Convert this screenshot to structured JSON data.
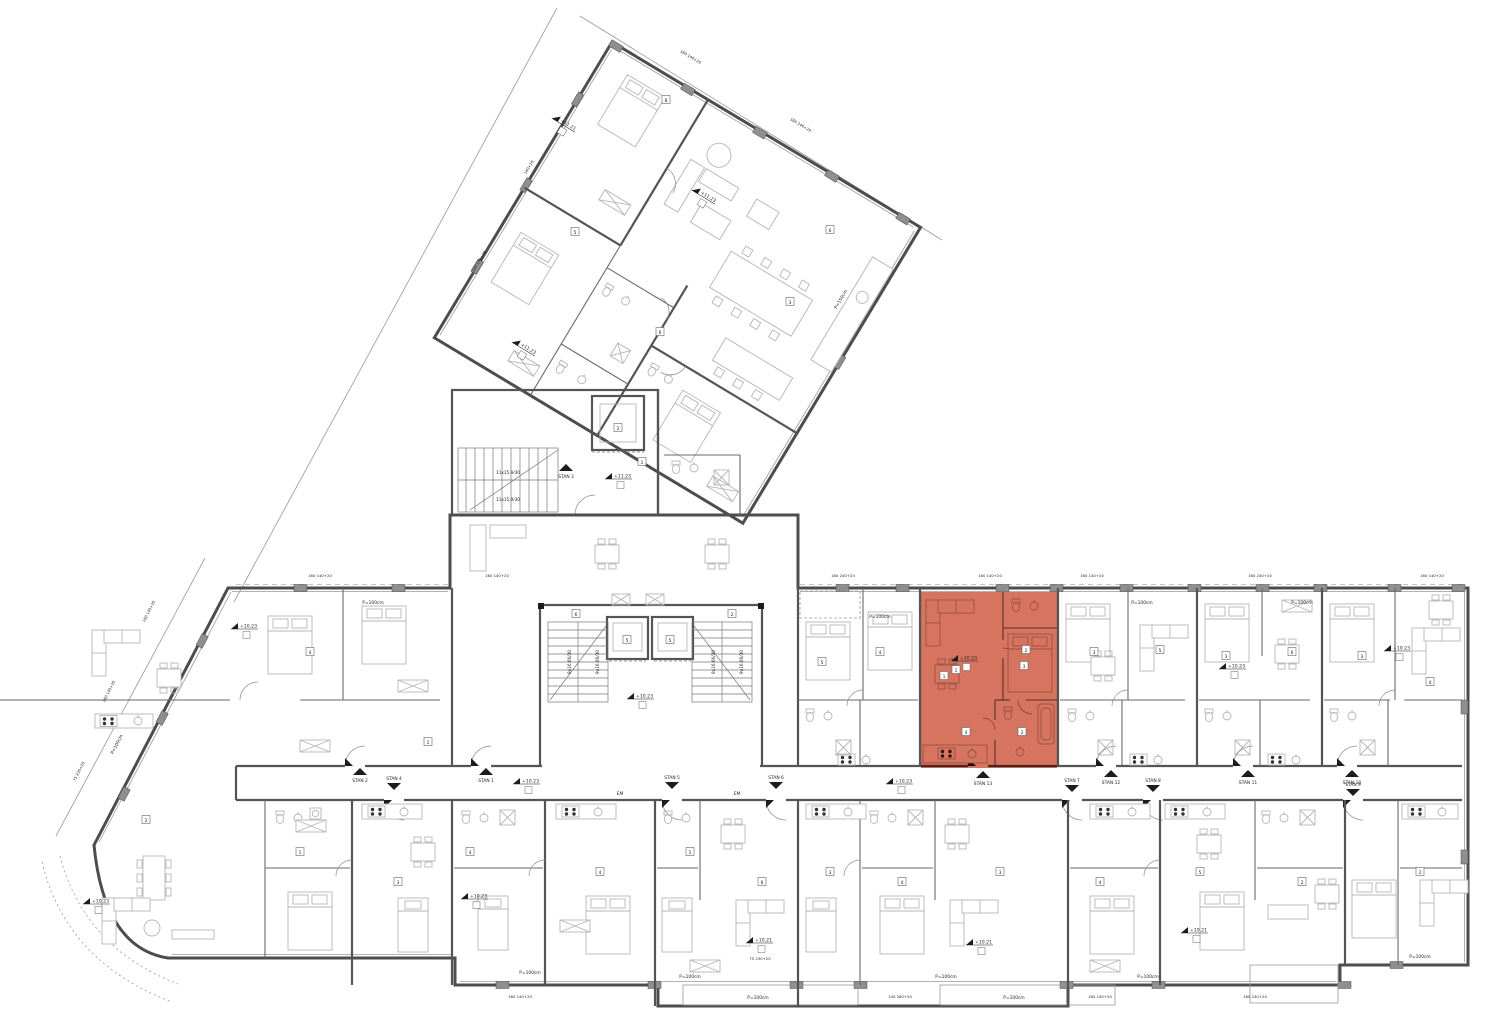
{
  "drawing": {
    "type": "residential floor plan",
    "highlight": {
      "unit": "STAN 13",
      "color": "#d2654e",
      "opacity": "0.9"
    },
    "colors": {
      "ink": "#1c1c1c",
      "wall": "#4d4d4d",
      "furniture": "#b5b5b5",
      "pillar": "#8f8f8f",
      "parcel": "#999999"
    }
  },
  "annotations": {
    "units": [
      {
        "name": "STAN 2",
        "x": 360,
        "y": 774,
        "dir": "up"
      },
      {
        "name": "STAN 4",
        "x": 394,
        "y": 784,
        "dir": "down"
      },
      {
        "name": "STAN 1",
        "x": 486,
        "y": 774,
        "dir": "up"
      },
      {
        "name": "STAN 3",
        "x": 566,
        "y": 470,
        "dir": "up"
      },
      {
        "name": "STAN 5",
        "x": 672,
        "y": 783,
        "dir": "down"
      },
      {
        "name": "STAN 6",
        "x": 776,
        "y": 783,
        "dir": "down"
      },
      {
        "name": "STAN 13",
        "x": 983,
        "y": 777,
        "dir": "up"
      },
      {
        "name": "STAN 7",
        "x": 1072,
        "y": 786,
        "dir": "down"
      },
      {
        "name": "STAN 12",
        "x": 1111,
        "y": 776,
        "dir": "up"
      },
      {
        "name": "STAN 8",
        "x": 1153,
        "y": 786,
        "dir": "down"
      },
      {
        "name": "STAN 11",
        "x": 1248,
        "y": 776,
        "dir": "up"
      },
      {
        "name": "STAN 10",
        "x": 1352,
        "y": 776,
        "dir": "up"
      },
      {
        "name": "STAN 9",
        "x": 1353,
        "y": 790,
        "dir": "down"
      }
    ],
    "levels": [
      {
        "text": "+10.23",
        "x": 240,
        "y": 628,
        "rot": 0
      },
      {
        "text": "+10.23",
        "x": 522,
        "y": 783,
        "rot": 0
      },
      {
        "text": "+10.23",
        "x": 636,
        "y": 698,
        "rot": 0
      },
      {
        "text": "+10.23",
        "x": 895,
        "y": 783,
        "rot": 0
      },
      {
        "text": "+10.23",
        "x": 960,
        "y": 660,
        "rot": 0
      },
      {
        "text": "+10.23",
        "x": 1228,
        "y": 668,
        "rot": 0
      },
      {
        "text": "+10.23",
        "x": 1393,
        "y": 650,
        "rot": 0
      },
      {
        "text": "+10.23",
        "x": 470,
        "y": 898,
        "rot": 0
      },
      {
        "text": "+10.23",
        "x": 92,
        "y": 903,
        "rot": 0
      },
      {
        "text": "+10.21",
        "x": 755,
        "y": 942,
        "rot": 0
      },
      {
        "text": "+10.21",
        "x": 975,
        "y": 944,
        "rot": 0
      },
      {
        "text": "+10.21",
        "x": 1190,
        "y": 932,
        "rot": 0
      },
      {
        "text": "+11.23",
        "x": 614,
        "y": 478,
        "rot": 0
      },
      {
        "text": "+11.23",
        "x": 700,
        "y": 194,
        "rot": 31
      },
      {
        "text": "+11.23",
        "x": 520,
        "y": 346,
        "rot": 31
      },
      {
        "text": "+11.21",
        "x": 560,
        "y": 122,
        "rot": 31
      }
    ],
    "stairs": [
      {
        "text": "9x16.66/30",
        "x": 571,
        "y": 662,
        "rot": -90
      },
      {
        "text": "9x16.66/30",
        "x": 599,
        "y": 662,
        "rot": -90
      },
      {
        "text": "9x16.66/30",
        "x": 715,
        "y": 662,
        "rot": -90
      },
      {
        "text": "9x16.66/30",
        "x": 743,
        "y": 662,
        "rot": -90
      },
      {
        "text": "11x15.9/30",
        "x": 508,
        "y": 474,
        "rot": 0
      },
      {
        "text": "11x15.9/30",
        "x": 508,
        "y": 501,
        "rot": 0
      }
    ],
    "notes": [
      {
        "text": "EM",
        "x": 620,
        "y": 795,
        "rot": 0
      },
      {
        "text": "EM",
        "x": 737,
        "y": 795,
        "rot": 0
      },
      {
        "text": "P=100cm",
        "x": 373,
        "y": 604,
        "rot": 0
      },
      {
        "text": "P=100cm",
        "x": 880,
        "y": 618,
        "rot": 0
      },
      {
        "text": "P=100cm",
        "x": 1142,
        "y": 604,
        "rot": 0
      },
      {
        "text": "P=100cm",
        "x": 1302,
        "y": 604,
        "rot": 0
      },
      {
        "text": "P=100cm",
        "x": 530,
        "y": 974,
        "rot": 0
      },
      {
        "text": "P=100cm",
        "x": 690,
        "y": 978,
        "rot": 0
      },
      {
        "text": "P=100cm",
        "x": 758,
        "y": 999,
        "rot": 0
      },
      {
        "text": "P=100cm",
        "x": 946,
        "y": 978,
        "rot": 0
      },
      {
        "text": "P=100cm",
        "x": 1014,
        "y": 999,
        "rot": 0
      },
      {
        "text": "P=100cm",
        "x": 1148,
        "y": 978,
        "rot": 0
      },
      {
        "text": "P=100cm",
        "x": 1420,
        "y": 958,
        "rot": 0
      },
      {
        "text": "P=100cm",
        "x": 118,
        "y": 745,
        "rot": -63
      },
      {
        "text": "P=150cm",
        "x": 842,
        "y": 300,
        "rot": -59
      }
    ],
    "dims": [
      {
        "text": "160  140+20",
        "x": 320,
        "y": 577,
        "rot": 0
      },
      {
        "text": "160  140+20",
        "x": 497,
        "y": 577,
        "rot": 0
      },
      {
        "text": "160  240+20",
        "x": 843,
        "y": 577,
        "rot": 0
      },
      {
        "text": "160  140+20",
        "x": 990,
        "y": 577,
        "rot": 0
      },
      {
        "text": "160  140+20",
        "x": 1092,
        "y": 577,
        "rot": 0
      },
      {
        "text": "160  240+20",
        "x": 1260,
        "y": 577,
        "rot": 0
      },
      {
        "text": "160  140+20",
        "x": 1432,
        "y": 577,
        "rot": 0
      },
      {
        "text": "160  140+20",
        "x": 520,
        "y": 998,
        "rot": 0
      },
      {
        "text": "75  230+20",
        "x": 760,
        "y": 960,
        "rot": 0
      },
      {
        "text": "140  260+20",
        "x": 900,
        "y": 998,
        "rot": 0
      },
      {
        "text": "160  140+20",
        "x": 1100,
        "y": 998,
        "rot": 0
      },
      {
        "text": "160  240+20",
        "x": 1255,
        "y": 998,
        "rot": 0
      },
      {
        "text": "160 140+20",
        "x": 150,
        "y": 612,
        "rot": -63
      },
      {
        "text": "160 140+20",
        "x": 110,
        "y": 692,
        "rot": -63
      },
      {
        "text": "75 230+20",
        "x": 80,
        "y": 772,
        "rot": -63
      },
      {
        "text": "160 140+20",
        "x": 690,
        "y": 58,
        "rot": 31
      },
      {
        "text": "160 240+20",
        "x": 800,
        "y": 126,
        "rot": 31
      },
      {
        "text": "140+20",
        "x": 530,
        "y": 168,
        "rot": -59
      },
      {
        "text": "160 140+20",
        "x": 480,
        "y": 262,
        "rot": -59
      }
    ],
    "room_tags": [
      {
        "text": "4",
        "x": 310,
        "y": 652
      },
      {
        "text": "1",
        "x": 428,
        "y": 742
      },
      {
        "text": "5",
        "x": 822,
        "y": 662
      },
      {
        "text": "4",
        "x": 880,
        "y": 652
      },
      {
        "text": "1",
        "x": 944,
        "y": 676
      },
      {
        "text": "2",
        "x": 1026,
        "y": 650
      },
      {
        "text": "3",
        "x": 1094,
        "y": 652
      },
      {
        "text": "5",
        "x": 1160,
        "y": 650
      },
      {
        "text": "3",
        "x": 1226,
        "y": 656
      },
      {
        "text": "6",
        "x": 1292,
        "y": 652
      },
      {
        "text": "3",
        "x": 1362,
        "y": 656
      },
      {
        "text": "4",
        "x": 1430,
        "y": 682
      },
      {
        "text": "1",
        "x": 300,
        "y": 852
      },
      {
        "text": "3",
        "x": 398,
        "y": 882
      },
      {
        "text": "4",
        "x": 470,
        "y": 852
      },
      {
        "text": "4",
        "x": 600,
        "y": 872
      },
      {
        "text": "1",
        "x": 690,
        "y": 852
      },
      {
        "text": "6",
        "x": 762,
        "y": 882
      },
      {
        "text": "3",
        "x": 830,
        "y": 872
      },
      {
        "text": "4",
        "x": 902,
        "y": 882
      },
      {
        "text": "3",
        "x": 1000,
        "y": 872
      },
      {
        "text": "4",
        "x": 1100,
        "y": 882
      },
      {
        "text": "5",
        "x": 1200,
        "y": 872
      },
      {
        "text": "2",
        "x": 1302,
        "y": 882
      },
      {
        "text": "2",
        "x": 1420,
        "y": 872
      },
      {
        "text": "2",
        "x": 146,
        "y": 820
      },
      {
        "text": "5",
        "x": 575,
        "y": 232
      },
      {
        "text": "6",
        "x": 660,
        "y": 332
      },
      {
        "text": "3",
        "x": 790,
        "y": 302
      },
      {
        "text": "1",
        "x": 642,
        "y": 462
      },
      {
        "text": "2",
        "x": 618,
        "y": 428
      },
      {
        "text": "6",
        "x": 576,
        "y": 614
      },
      {
        "text": "5",
        "x": 627,
        "y": 640
      },
      {
        "text": "5",
        "x": 670,
        "y": 640
      },
      {
        "text": "2",
        "x": 732,
        "y": 614
      },
      {
        "text": "1",
        "x": 956,
        "y": 670
      },
      {
        "text": "3",
        "x": 1024,
        "y": 666
      },
      {
        "text": "2",
        "x": 1022,
        "y": 732
      },
      {
        "text": "4",
        "x": 966,
        "y": 732
      },
      {
        "text": "8",
        "x": 666,
        "y": 100
      },
      {
        "text": "6",
        "x": 830,
        "y": 230
      }
    ]
  }
}
